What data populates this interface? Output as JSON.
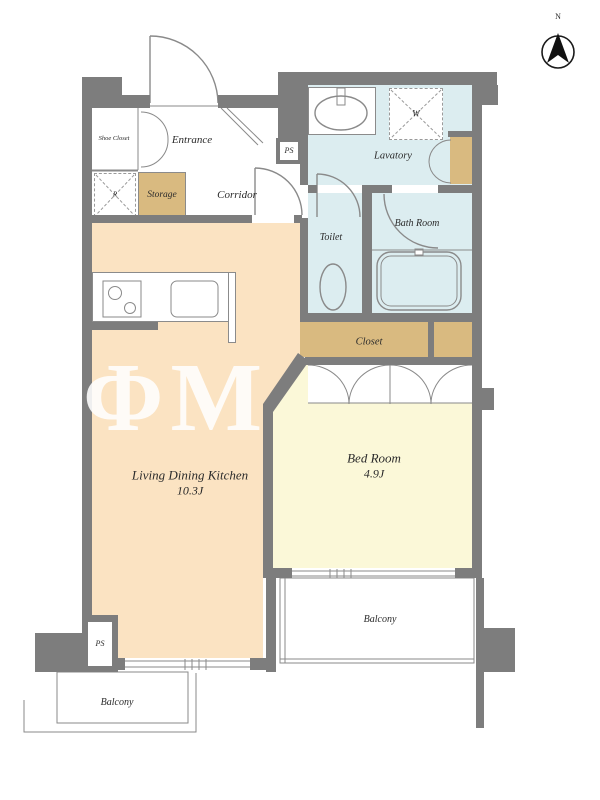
{
  "colors": {
    "wall": "#7d7d7d",
    "ldk_floor": "#fbe3c2",
    "bedroom_floor": "#fbf8d8",
    "wet_floor": "#dcedf0",
    "storage_fill": "#d9ba80",
    "line": "#8a8a8a",
    "label_text": "#2b2b2b",
    "watermark": "#ffffff"
  },
  "compass": {
    "label": "N"
  },
  "watermark": {
    "text": "RΦM"
  },
  "rooms": {
    "ldk": {
      "label": "Living Dining Kitchen",
      "area": "10.3J"
    },
    "bedroom": {
      "label": "Bed Room",
      "area": "4.9J"
    },
    "entrance": {
      "label": "Entrance"
    },
    "shoe_closet": {
      "label": "Shoe Closet"
    },
    "storage": {
      "label": "Storage"
    },
    "corridor": {
      "label": "Corridor"
    },
    "lavatory": {
      "label": "Lavatory"
    },
    "toilet": {
      "label": "Toilet"
    },
    "bath_room": {
      "label": "Bath Room"
    },
    "closet": {
      "label": "Closet"
    },
    "balcony_right": {
      "label": "Balcony"
    },
    "balcony_left": {
      "label": "Balcony"
    }
  },
  "fixtures": {
    "pipe_space_top": {
      "label": "PS"
    },
    "pipe_space_bottom": {
      "label": "PS"
    },
    "refrigerator": {
      "label": "R"
    },
    "washing_machine": {
      "label": "W"
    }
  }
}
